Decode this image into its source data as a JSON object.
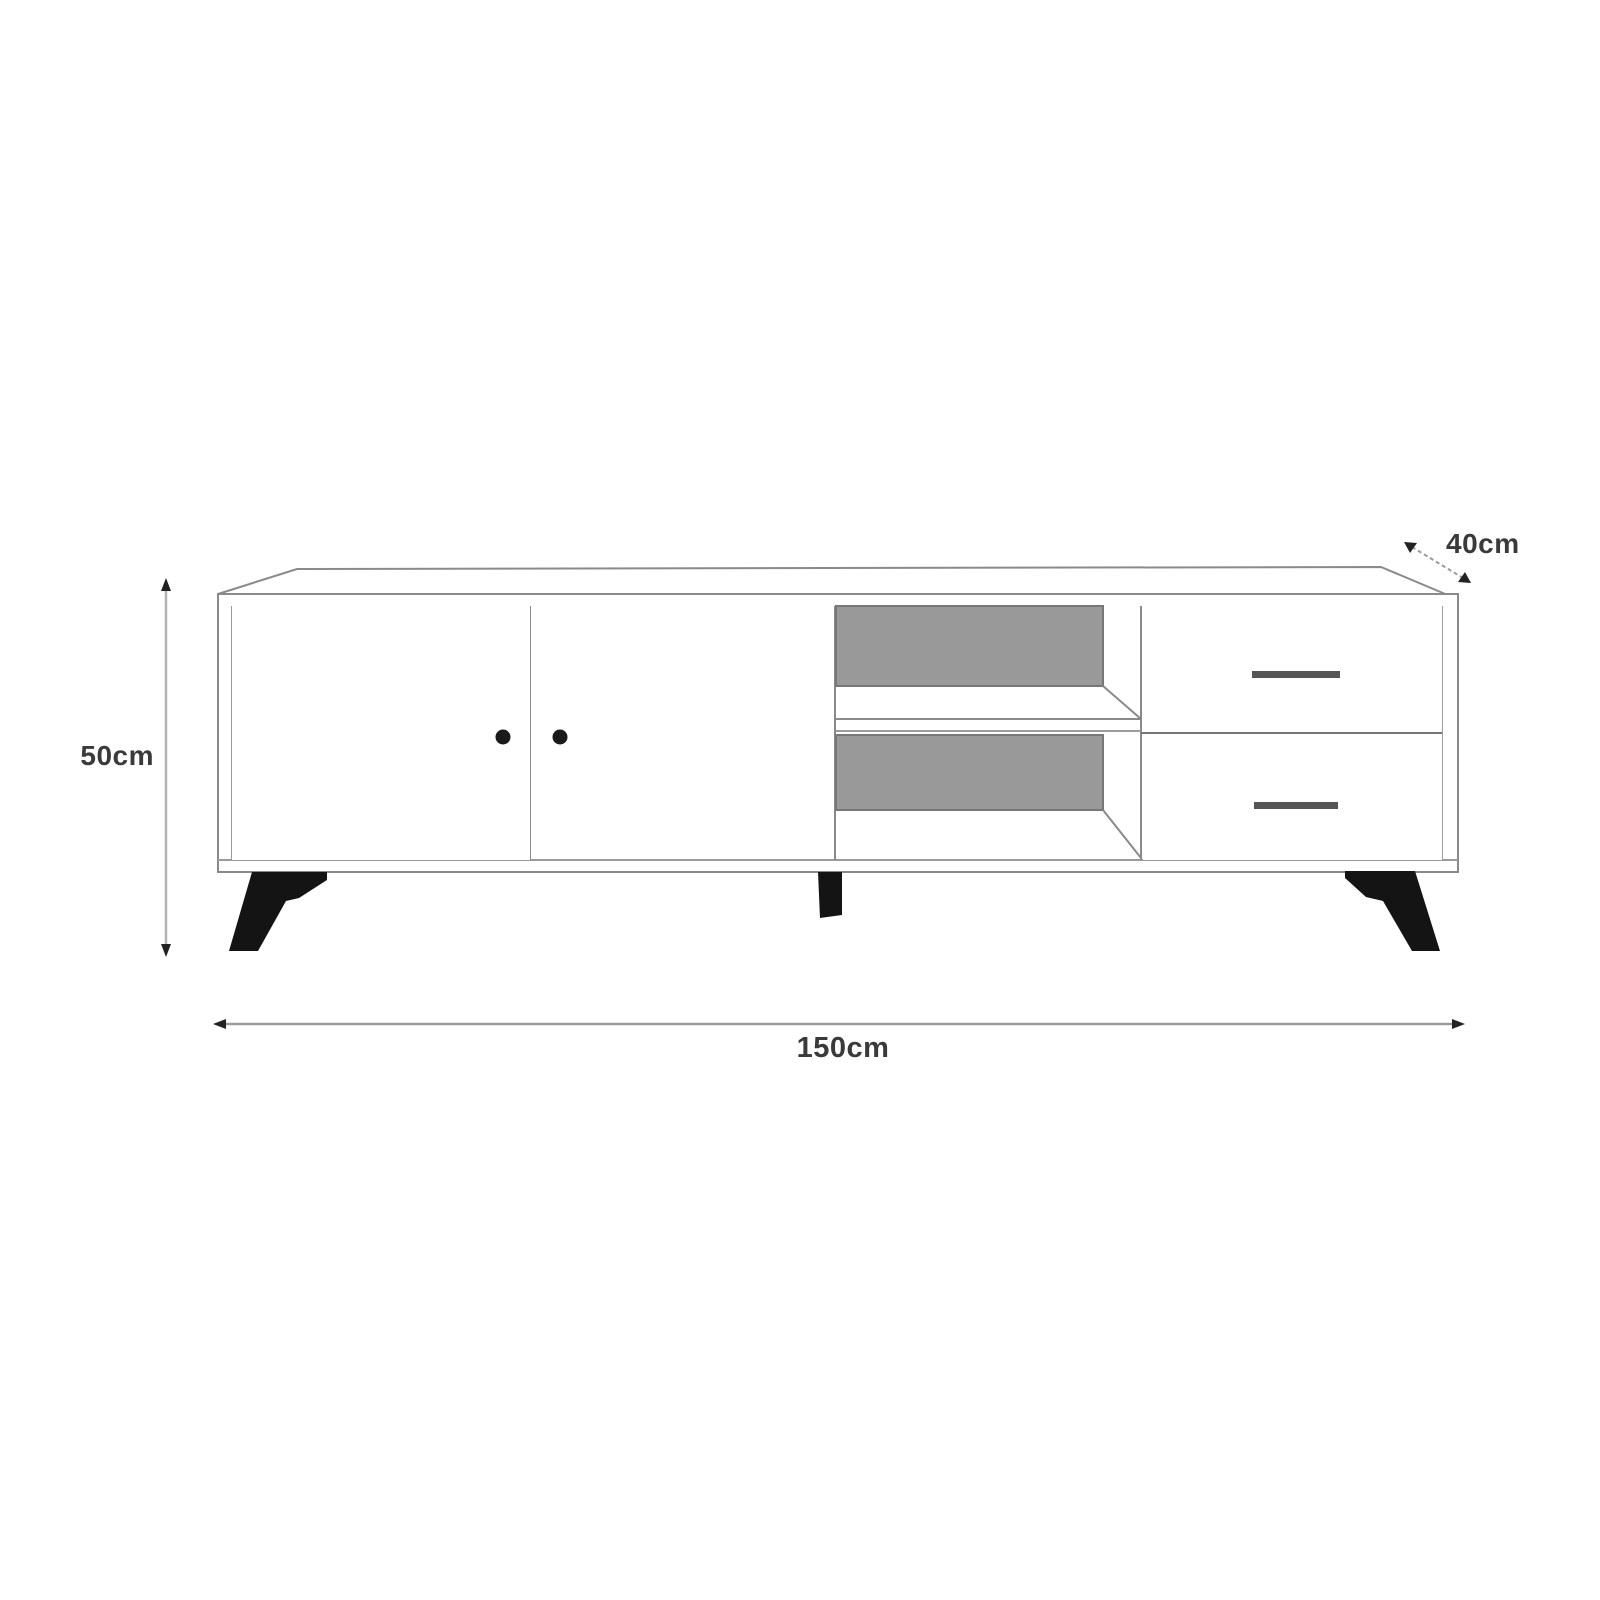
{
  "diagram": {
    "subject": "TV stand technical dimension drawing",
    "labels": {
      "height": "50cm",
      "width": "150cm",
      "depth": "40cm"
    }
  },
  "colors": {
    "background": "#ffffff",
    "outline": "#8a8a8a",
    "outline_light": "#a5a5a5",
    "panel_gray": "#999999",
    "panel_border": "#777777",
    "handle": "#555555",
    "leg_black": "#141414",
    "knob_black": "#1a1a1a",
    "arrow": "#222222",
    "text": "#3a3a3a"
  }
}
